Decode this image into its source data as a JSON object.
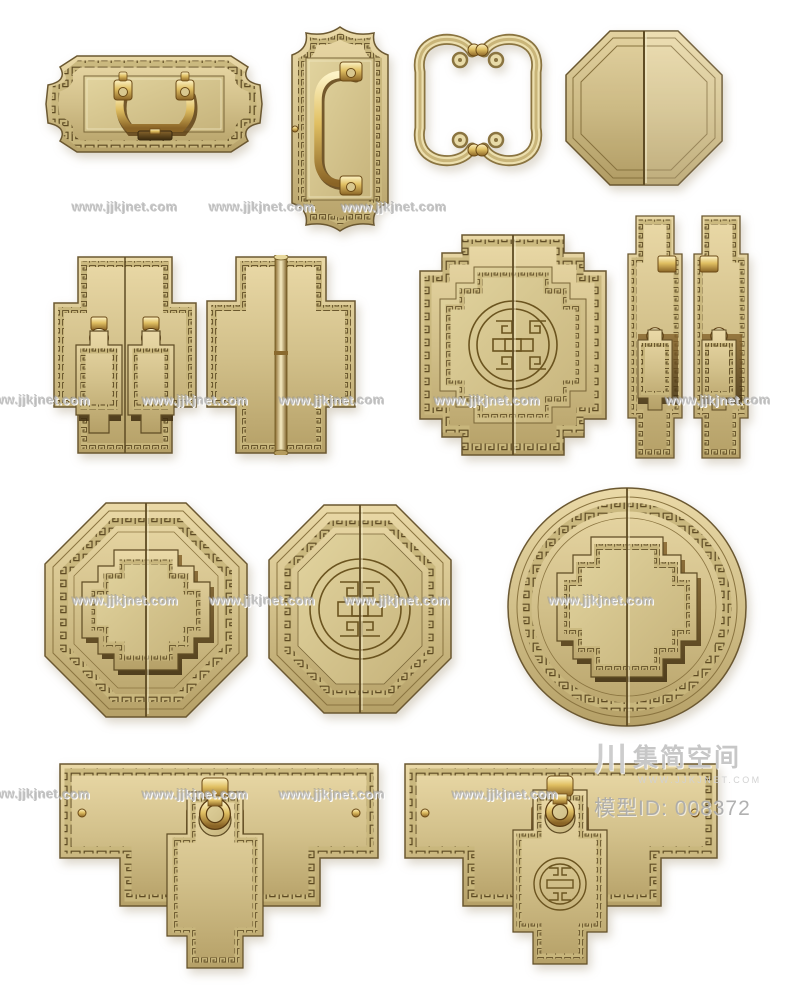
{
  "page": {
    "type": "3d-model-product-render",
    "background": "#ffffff"
  },
  "watermark": {
    "text": "www.jjkjnet.com",
    "color": "#c8c8c8",
    "positions": [
      {
        "x": 125,
        "y": 207
      },
      {
        "x": 262,
        "y": 207
      },
      {
        "x": 394,
        "y": 207
      },
      {
        "x": 37,
        "y": 400
      },
      {
        "x": 195,
        "y": 400
      },
      {
        "x": 332,
        "y": 400
      },
      {
        "x": 487,
        "y": 400
      },
      {
        "x": 718,
        "y": 400
      },
      {
        "x": 125,
        "y": 600
      },
      {
        "x": 262,
        "y": 600
      },
      {
        "x": 397,
        "y": 600
      },
      {
        "x": 601,
        "y": 600
      },
      {
        "x": 37,
        "y": 794
      },
      {
        "x": 195,
        "y": 794
      },
      {
        "x": 332,
        "y": 794
      },
      {
        "x": 505,
        "y": 794
      }
    ]
  },
  "branding": {
    "logo_mark": "川",
    "logo_name": "集简空间",
    "logo_site": "WWW.JJKJNET.COM",
    "model_id_label": "模型ID:",
    "model_id_value": "008372",
    "text_color": "#b6b6b6"
  },
  "items": [
    {
      "name": "lobed-rect-backplate-with-bail-handle",
      "row": 1
    },
    {
      "name": "vertical-lobed-plate-with-bail-handle",
      "row": 1
    },
    {
      "name": "pair-of-openwork-cloud-scroll-pulls",
      "row": 1
    },
    {
      "name": "split-octagon-door-plates",
      "row": 1
    },
    {
      "name": "double-stepped-plates-with-drop-pendants",
      "row": 2
    },
    {
      "name": "stepped-plate-hinge-with-barrel",
      "row": 2
    },
    {
      "name": "stepped-square-plate-with-longevity-medallion",
      "row": 2
    },
    {
      "name": "pair-of-tall-plates-with-knobs-and-pendants",
      "row": 2
    },
    {
      "name": "octagon-plate-with-raised-stepped-cross",
      "row": 3
    },
    {
      "name": "octagon-plate-with-engraved-longevity-medallion",
      "row": 3
    },
    {
      "name": "round-plate-with-raised-stepped-cross",
      "row": 3
    },
    {
      "name": "bar-backplate-with-hanging-pendant",
      "row": 4
    },
    {
      "name": "bar-backplate-with-medallion-pendant",
      "row": 4
    }
  ],
  "colors": {
    "brass_light": "#ead9a7",
    "brass_mid": "#d2c08a",
    "brass_dark": "#b5a067",
    "engrave": "#57441d",
    "gold_bright": "#fdf3c6",
    "gold_deep": "#8a6426",
    "recess": "#3c2b0e",
    "watermark": "#c8c8c8",
    "meta_text": "#a8a8a8",
    "background": "#ffffff"
  }
}
